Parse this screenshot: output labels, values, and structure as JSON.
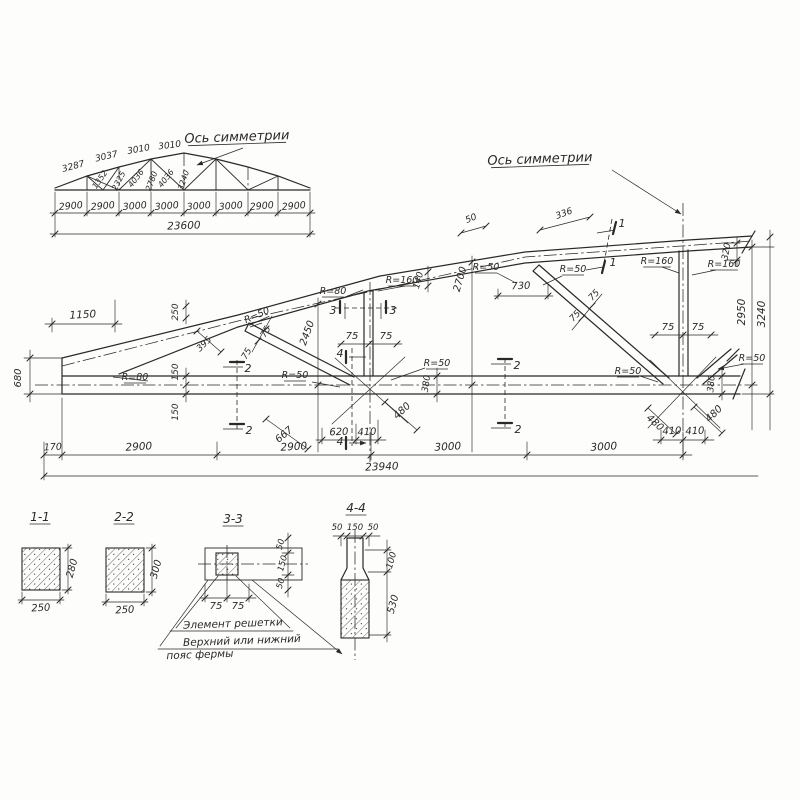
{
  "drawing": {
    "kind": "truss structural drawing",
    "language": "ru",
    "ink": "#2b2925",
    "paper": "#fdfdfc",
    "overview": {
      "symmetry_axis_label": "Ось симметрии",
      "top_chord_segments": [
        "3287",
        "3037",
        "3010",
        "3010"
      ],
      "web_member_lengths": [
        "1352",
        "2325",
        "4036",
        "2780",
        "4036",
        "3240"
      ],
      "panel_dims": [
        "2900",
        "2900",
        "3000",
        "3000",
        "3000",
        "3000",
        "2900",
        "2900"
      ],
      "total_span": "23600"
    },
    "main_view": {
      "symmetry_axis_label": "Ось симметрии",
      "bottom_dims": [
        "170",
        "2900",
        "2900",
        "3000",
        "3000"
      ],
      "total_span": "23940",
      "heights": [
        "2950",
        "3240"
      ],
      "chord_detail_dims": [
        "1150",
        "680",
        "250",
        "395",
        "150",
        "150",
        "140",
        "2700",
        "730",
        "320",
        "380",
        "380",
        "2450",
        "50",
        "336"
      ],
      "node_dims": [
        "620",
        "410",
        "667",
        "480",
        "480",
        "480",
        "410",
        "410"
      ],
      "member_half_widths": [
        "75",
        "75"
      ],
      "radius_labels": [
        "R=80",
        "R=80",
        "R=160",
        "R=50",
        "R=50",
        "R=50",
        "R=50",
        "R=50",
        "R=160",
        "R=160",
        "R=50",
        "R=50"
      ],
      "section_marks": [
        "1",
        "2",
        "3",
        "4"
      ]
    },
    "sections": {
      "s11": {
        "title": "1-1",
        "width": "250",
        "height": "280"
      },
      "s22": {
        "title": "2-2",
        "width": "250",
        "height": "300"
      },
      "s33": {
        "title": "3-3",
        "bottom_dims": [
          "75",
          "75"
        ],
        "side_dims": [
          "50",
          "150",
          "50"
        ]
      },
      "s44": {
        "title": "4-4",
        "top_dims": [
          "50",
          "150",
          "50"
        ],
        "side_dims": [
          "100",
          "530"
        ]
      },
      "notes": [
        "Элемент решетки",
        "Верхний или нижний",
        "пояс фермы"
      ]
    }
  },
  "annotations": [
    {
      "t": "Ось симметрии",
      "x": 237,
      "y": 141,
      "r": -2,
      "s": 13,
      "ul": 1,
      "g": "axis-label"
    },
    {
      "t": "3287",
      "x": 74,
      "y": 169,
      "r": -15,
      "s": 9,
      "g": "chord-dim"
    },
    {
      "t": "3037",
      "x": 107,
      "y": 159,
      "r": -13,
      "s": 9,
      "g": "chord-dim"
    },
    {
      "t": "3010",
      "x": 139,
      "y": 152,
      "r": -10,
      "s": 9,
      "g": "chord-dim"
    },
    {
      "t": "3010",
      "x": 170,
      "y": 148,
      "r": -7,
      "s": 9,
      "g": "chord-dim"
    },
    {
      "t": "1352",
      "x": 102,
      "y": 181,
      "r": -55,
      "s": 8,
      "g": "web-dim"
    },
    {
      "t": "2325",
      "x": 121,
      "y": 182,
      "r": -63,
      "s": 8,
      "g": "web-dim"
    },
    {
      "t": "4036",
      "x": 138,
      "y": 180,
      "r": -52,
      "s": 8,
      "g": "web-dim"
    },
    {
      "t": "2780",
      "x": 154,
      "y": 182,
      "r": -70,
      "s": 8,
      "g": "web-dim"
    },
    {
      "t": "4036",
      "x": 168,
      "y": 180,
      "r": -52,
      "s": 8,
      "g": "web-dim"
    },
    {
      "t": "3240",
      "x": 186,
      "y": 181,
      "r": -72,
      "s": 8,
      "g": "web-dim"
    },
    {
      "t": "2900",
      "x": 71,
      "y": 209,
      "r": -5,
      "s": 9.5,
      "g": "panel-dim"
    },
    {
      "t": "2900",
      "x": 103,
      "y": 209,
      "r": -5,
      "s": 9.5,
      "g": "panel-dim"
    },
    {
      "t": "3000",
      "x": 135,
      "y": 209,
      "r": -5,
      "s": 9.5,
      "g": "panel-dim"
    },
    {
      "t": "3000",
      "x": 167,
      "y": 209,
      "r": -5,
      "s": 9.5,
      "g": "panel-dim"
    },
    {
      "t": "3000",
      "x": 199,
      "y": 209,
      "r": -5,
      "s": 9.5,
      "g": "panel-dim"
    },
    {
      "t": "3000",
      "x": 231,
      "y": 209,
      "r": -5,
      "s": 9.5,
      "g": "panel-dim"
    },
    {
      "t": "2900",
      "x": 262,
      "y": 209,
      "r": -5,
      "s": 9.5,
      "g": "panel-dim"
    },
    {
      "t": "2900",
      "x": 294,
      "y": 209,
      "r": -5,
      "s": 9.5,
      "g": "panel-dim"
    },
    {
      "t": "23600",
      "x": 184,
      "y": 229,
      "r": -2,
      "s": 10.5,
      "g": "total-dim"
    },
    {
      "t": "Ось симметрии",
      "x": 540,
      "y": 163,
      "r": -2,
      "s": 13,
      "ul": 1,
      "g": "axis-label"
    },
    {
      "t": "1150",
      "x": 83,
      "y": 318,
      "r": -3,
      "s": 10.5,
      "g": "dim"
    },
    {
      "t": "680",
      "x": 21,
      "y": 378,
      "r": -90,
      "s": 10,
      "g": "dim"
    },
    {
      "t": "170",
      "x": 53,
      "y": 450,
      "r": -3,
      "s": 9.5,
      "g": "dim"
    },
    {
      "t": "2900",
      "x": 139,
      "y": 450,
      "r": -3,
      "s": 10.5,
      "g": "dim"
    },
    {
      "t": "2900",
      "x": 294,
      "y": 450,
      "r": -3,
      "s": 10.5,
      "g": "dim"
    },
    {
      "t": "3000",
      "x": 448,
      "y": 450,
      "r": -3,
      "s": 10.5,
      "g": "dim"
    },
    {
      "t": "3000",
      "x": 604,
      "y": 450,
      "r": -3,
      "s": 10.5,
      "g": "dim"
    },
    {
      "t": "23940",
      "x": 382,
      "y": 470,
      "r": -2,
      "s": 10.5,
      "g": "total-dim"
    },
    {
      "t": "2950",
      "x": 745,
      "y": 312,
      "r": -90,
      "s": 10.5,
      "g": "dim"
    },
    {
      "t": "3240",
      "x": 765,
      "y": 314,
      "r": -90,
      "s": 10.5,
      "g": "dim"
    },
    {
      "t": "320",
      "x": 729,
      "y": 252,
      "r": -80,
      "s": 9,
      "g": "dim"
    },
    {
      "t": "380",
      "x": 714,
      "y": 384,
      "r": -85,
      "s": 9,
      "g": "dim"
    },
    {
      "t": "380",
      "x": 429,
      "y": 384,
      "r": -82,
      "s": 9,
      "g": "dim"
    },
    {
      "t": "140",
      "x": 421,
      "y": 281,
      "r": -75,
      "s": 9,
      "g": "dim"
    },
    {
      "t": "2700",
      "x": 463,
      "y": 280,
      "r": -74,
      "s": 10,
      "g": "dim"
    },
    {
      "t": "730",
      "x": 521,
      "y": 289,
      "r": -2,
      "s": 10,
      "g": "dim"
    },
    {
      "t": "250",
      "x": 178,
      "y": 312,
      "r": -90,
      "s": 9,
      "g": "dim"
    },
    {
      "t": "395",
      "x": 206,
      "y": 346,
      "r": -44,
      "s": 9,
      "g": "dim"
    },
    {
      "t": "150",
      "x": 178,
      "y": 372,
      "r": -90,
      "s": 9,
      "g": "dim"
    },
    {
      "t": "150",
      "x": 178,
      "y": 412,
      "r": -90,
      "s": 9,
      "g": "dim"
    },
    {
      "t": "75",
      "x": 352,
      "y": 339,
      "r": 0,
      "s": 10,
      "g": "dim"
    },
    {
      "t": "75",
      "x": 386,
      "y": 339,
      "r": 0,
      "s": 10,
      "g": "dim"
    },
    {
      "t": "75",
      "x": 668,
      "y": 330,
      "r": 0,
      "s": 10,
      "g": "dim"
    },
    {
      "t": "75",
      "x": 698,
      "y": 330,
      "r": 0,
      "s": 10,
      "g": "dim"
    },
    {
      "t": "75",
      "x": 249,
      "y": 355,
      "r": -60,
      "s": 9,
      "g": "dim"
    },
    {
      "t": "75",
      "x": 268,
      "y": 333,
      "r": -60,
      "s": 9,
      "g": "dim"
    },
    {
      "t": "75",
      "x": 596,
      "y": 297,
      "r": -47,
      "s": 9,
      "g": "dim"
    },
    {
      "t": "75",
      "x": 577,
      "y": 318,
      "r": -47,
      "s": 9,
      "g": "dim"
    },
    {
      "t": "2450",
      "x": 310,
      "y": 334,
      "r": -70,
      "s": 10,
      "g": "dim"
    },
    {
      "t": "620",
      "x": 339,
      "y": 435,
      "r": -2,
      "s": 10,
      "g": "dim"
    },
    {
      "t": "410",
      "x": 367,
      "y": 435,
      "r": -2,
      "s": 10,
      "g": "dim"
    },
    {
      "t": "667",
      "x": 286,
      "y": 437,
      "r": -40,
      "s": 10,
      "g": "dim"
    },
    {
      "t": "480",
      "x": 404,
      "y": 413,
      "r": -43,
      "s": 10,
      "g": "dim"
    },
    {
      "t": "480",
      "x": 653,
      "y": 425,
      "r": 42,
      "s": 10,
      "g": "dim"
    },
    {
      "t": "480",
      "x": 716,
      "y": 416,
      "r": -44,
      "s": 10,
      "g": "dim"
    },
    {
      "t": "410",
      "x": 672,
      "y": 434,
      "r": -2,
      "s": 10,
      "g": "dim"
    },
    {
      "t": "410",
      "x": 695,
      "y": 434,
      "r": -2,
      "s": 10,
      "g": "dim"
    },
    {
      "t": "50",
      "x": 472,
      "y": 221,
      "r": -22,
      "s": 9,
      "g": "dim"
    },
    {
      "t": "336",
      "x": 565,
      "y": 216,
      "r": -20,
      "s": 9,
      "g": "dim"
    },
    {
      "t": "R=80",
      "x": 135,
      "y": 380,
      "r": 0,
      "s": 9.5,
      "ul": 1,
      "g": "radius"
    },
    {
      "t": "R=80",
      "x": 333,
      "y": 294,
      "r": 0,
      "s": 9.5,
      "ul": 1,
      "g": "radius"
    },
    {
      "t": "R=160",
      "x": 402,
      "y": 283,
      "r": 0,
      "s": 9.5,
      "ul": 1,
      "g": "radius"
    },
    {
      "t": "R=50",
      "x": 258,
      "y": 318,
      "r": -24,
      "s": 9.5,
      "ul": 1,
      "g": "radius"
    },
    {
      "t": "R=50",
      "x": 295,
      "y": 378,
      "r": 0,
      "s": 9.5,
      "ul": 1,
      "g": "radius"
    },
    {
      "t": "R=50",
      "x": 437,
      "y": 366,
      "r": 0,
      "s": 9.5,
      "ul": 1,
      "g": "radius"
    },
    {
      "t": "R=50",
      "x": 486,
      "y": 270,
      "r": 0,
      "s": 9.5,
      "ul": 1,
      "g": "radius"
    },
    {
      "t": "R=50",
      "x": 573,
      "y": 272,
      "r": 0,
      "s": 9.5,
      "ul": 1,
      "g": "radius"
    },
    {
      "t": "R=160",
      "x": 657,
      "y": 264,
      "r": 0,
      "s": 9.5,
      "ul": 1,
      "g": "radius"
    },
    {
      "t": "R=160",
      "x": 724,
      "y": 267,
      "r": 0,
      "s": 9.5,
      "ul": 1,
      "g": "radius"
    },
    {
      "t": "R=50",
      "x": 628,
      "y": 374,
      "r": 0,
      "s": 9.5,
      "ul": 1,
      "g": "radius"
    },
    {
      "t": "R=50",
      "x": 752,
      "y": 361,
      "r": 0,
      "s": 9.5,
      "ul": 1,
      "g": "radius"
    },
    {
      "t": "1",
      "x": 622,
      "y": 227,
      "r": 0,
      "s": 11,
      "g": "section-mark"
    },
    {
      "t": "1",
      "x": 613,
      "y": 266,
      "r": 0,
      "s": 11,
      "g": "section-mark"
    },
    {
      "t": "2",
      "x": 248,
      "y": 372,
      "r": 0,
      "s": 11,
      "g": "section-mark"
    },
    {
      "t": "2",
      "x": 249,
      "y": 434,
      "r": 0,
      "s": 11,
      "g": "section-mark"
    },
    {
      "t": "2",
      "x": 517,
      "y": 369,
      "r": 0,
      "s": 11,
      "g": "section-mark"
    },
    {
      "t": "2",
      "x": 518,
      "y": 433,
      "r": 0,
      "s": 11,
      "g": "section-mark"
    },
    {
      "t": "3",
      "x": 333,
      "y": 314,
      "r": 0,
      "s": 11,
      "g": "section-mark"
    },
    {
      "t": "3",
      "x": 393,
      "y": 314,
      "r": 0,
      "s": 11,
      "g": "section-mark"
    },
    {
      "t": "4",
      "x": 340,
      "y": 357,
      "r": 0,
      "s": 11,
      "g": "section-mark"
    },
    {
      "t": "4",
      "x": 340,
      "y": 445,
      "r": 0,
      "s": 11,
      "g": "section-mark"
    },
    {
      "t": "1-1",
      "x": 40,
      "y": 521,
      "r": 0,
      "s": 12,
      "ul": 1,
      "g": "section-title"
    },
    {
      "t": "250",
      "x": 41,
      "y": 611,
      "r": -3,
      "s": 10,
      "g": "dim"
    },
    {
      "t": "280",
      "x": 75,
      "y": 569,
      "r": -75,
      "s": 10,
      "g": "dim"
    },
    {
      "t": "2-2",
      "x": 124,
      "y": 521,
      "r": 0,
      "s": 12,
      "ul": 1,
      "g": "section-title"
    },
    {
      "t": "250",
      "x": 125,
      "y": 613,
      "r": -3,
      "s": 10,
      "g": "dim"
    },
    {
      "t": "300",
      "x": 159,
      "y": 570,
      "r": -75,
      "s": 10,
      "g": "dim"
    },
    {
      "t": "3-3",
      "x": 233,
      "y": 523,
      "r": 0,
      "s": 12,
      "ul": 1,
      "g": "section-title"
    },
    {
      "t": "75",
      "x": 216,
      "y": 609,
      "r": 0,
      "s": 10,
      "g": "dim"
    },
    {
      "t": "75",
      "x": 238,
      "y": 609,
      "r": 0,
      "s": 10,
      "g": "dim"
    },
    {
      "t": "50",
      "x": 283,
      "y": 545,
      "r": -75,
      "s": 8.5,
      "g": "dim"
    },
    {
      "t": "150",
      "x": 285,
      "y": 564,
      "r": -75,
      "s": 8.5,
      "g": "dim"
    },
    {
      "t": "50",
      "x": 283,
      "y": 584,
      "r": -75,
      "s": 8.5,
      "g": "dim"
    },
    {
      "t": "4-4",
      "x": 356,
      "y": 512,
      "r": 0,
      "s": 12,
      "ul": 1,
      "g": "section-title"
    },
    {
      "t": "50",
      "x": 337,
      "y": 530,
      "r": 0,
      "s": 8.5,
      "g": "dim"
    },
    {
      "t": "150",
      "x": 355,
      "y": 530,
      "r": 0,
      "s": 8.5,
      "g": "dim"
    },
    {
      "t": "50",
      "x": 373,
      "y": 530,
      "r": 0,
      "s": 8.5,
      "g": "dim"
    },
    {
      "t": "100",
      "x": 394,
      "y": 561,
      "r": -75,
      "s": 9,
      "g": "dim"
    },
    {
      "t": "530",
      "x": 396,
      "y": 605,
      "r": -75,
      "s": 10,
      "g": "dim"
    },
    {
      "t": "Элемент решетки",
      "x": 233,
      "y": 627,
      "r": -2,
      "s": 10.5,
      "g": "note"
    },
    {
      "t": "Верхний или нижний",
      "x": 242,
      "y": 644,
      "r": -2,
      "s": 10.5,
      "g": "note"
    },
    {
      "t": "пояс фермы",
      "x": 200,
      "y": 658,
      "r": -2,
      "s": 10.5,
      "g": "note"
    }
  ]
}
